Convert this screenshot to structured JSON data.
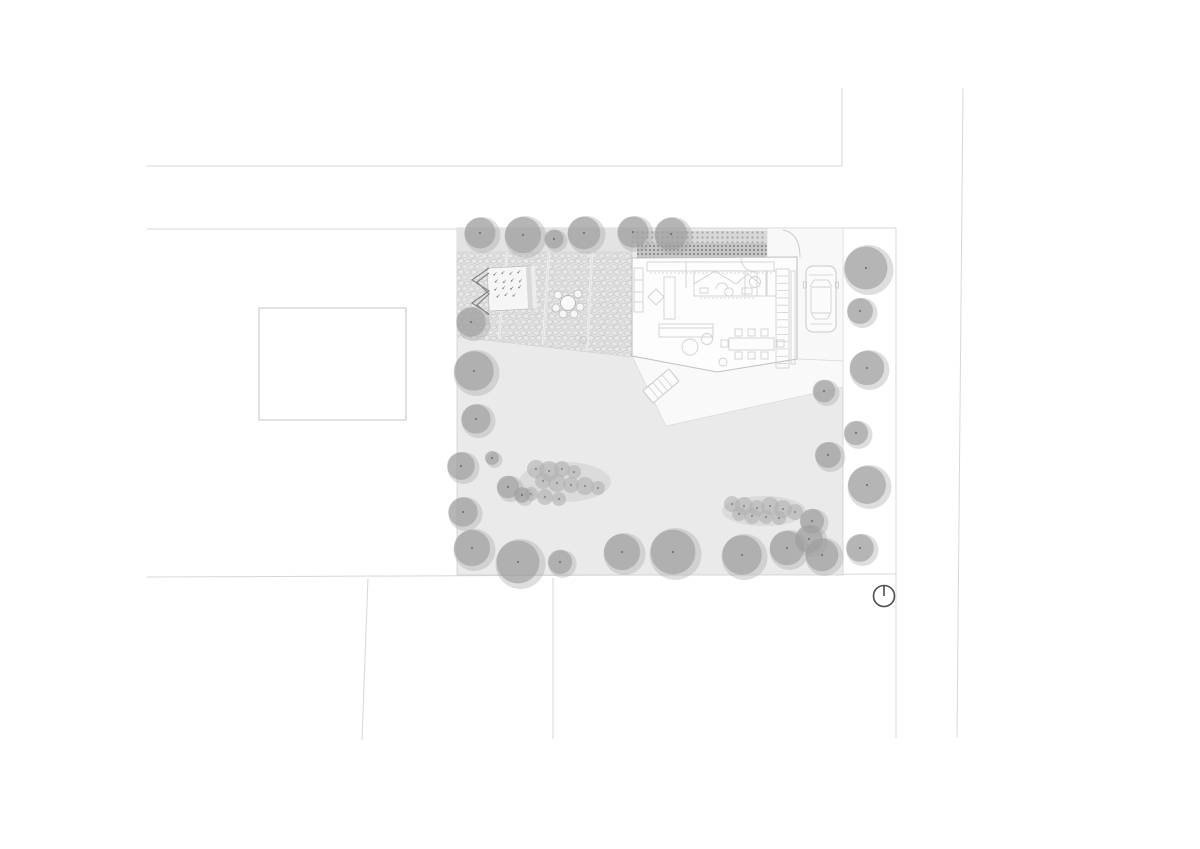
{
  "meta": {
    "title": "architectural-site-plan",
    "width": 1200,
    "height": 849
  },
  "colors": {
    "background": "#ffffff",
    "street_line": "#d7d7d7",
    "garden_fill": "#eaeaea",
    "garden_edge": "#cfcfcf",
    "band_fill": "#e3e3e3",
    "paving_bg": "#e1e1e1",
    "stone_line": "#c6c6c6",
    "stone_fill": "#e8e8e8",
    "joint_light": "#efefef",
    "joint_dark": "#d6d6d6",
    "hatch_light": "#d8d8d8",
    "hatch_dark": "#c7c7c7",
    "dot_light": "#a5a5a5",
    "dot_dark": "#8a8a8a",
    "white_area": "#f8f8f8",
    "white_edge": "#dadada",
    "house_fill": "#fdfdfd",
    "house_outline": "#c2c2c2",
    "furniture": "#d1d1d1",
    "tree_outer": "#a9a9a9",
    "tree_inner": "#9d9d9d",
    "tree_dot": "#6f6f6f",
    "bush_fill": "#b0b0b0",
    "bush_halo": "#c6c6c6",
    "bush_dot": "#838383",
    "bed_line": "#868686",
    "plant_dot": "#8f8f8f",
    "north": "#4d4d4d"
  },
  "streets": {
    "lines": [
      {
        "x1": 147,
        "y1": 166,
        "x2": 842,
        "y2": 166
      },
      {
        "x1": 842,
        "y1": 166,
        "x2": 842,
        "y2": 88
      },
      {
        "x1": 147,
        "y1": 229,
        "x2": 457,
        "y2": 229
      },
      {
        "x1": 963,
        "y1": 88,
        "x2": 957,
        "y2": 737
      },
      {
        "x1": 147,
        "y1": 577,
        "x2": 896,
        "y2": 574
      },
      {
        "x1": 368,
        "y1": 578,
        "x2": 362,
        "y2": 740
      },
      {
        "x1": 553,
        "y1": 578,
        "x2": 553,
        "y2": 739
      },
      {
        "x1": 896,
        "y1": 228,
        "x2": 896,
        "y2": 738
      },
      {
        "x1": 843,
        "y1": 228,
        "x2": 896,
        "y2": 228
      }
    ]
  },
  "neighbor_building": {
    "x": 259,
    "y": 308,
    "w": 147,
    "h": 112
  },
  "site": {
    "garden": {
      "x": 457,
      "y": 228,
      "w": 386,
      "h": 347
    },
    "band": {
      "x": 457,
      "y": 228,
      "w": 175,
      "h": 24
    },
    "paving_points": "457,252 632,252 632,357 457,337",
    "paving_joints": [
      {
        "x1": 507,
        "y1": 252,
        "x2": 499,
        "y2": 338
      },
      {
        "x1": 549,
        "y1": 252,
        "x2": 543,
        "y2": 344
      },
      {
        "x1": 592,
        "y1": 252,
        "x2": 587,
        "y2": 351
      }
    ],
    "wall_line": {
      "x1": 632,
      "y1": 228,
      "x2": 632,
      "y2": 258
    },
    "hatch_strips": [
      {
        "x": 632,
        "y": 231,
        "w": 135,
        "h": 12,
        "tone": "light"
      },
      {
        "x": 637,
        "y": 243,
        "w": 130,
        "h": 15,
        "tone": "dark"
      }
    ],
    "entry_points": "767,228 843,228 843,361 797,359 797,258 767,258",
    "deck_points": "632,356 717,371 797,359 843,361 843,387 666,426"
  },
  "planted_bed": {
    "rotation": -3,
    "cx": 510,
    "cy": 288,
    "rect": {
      "x": 488,
      "y": 267,
      "w": 45,
      "h": 43
    },
    "strips": [
      {
        "x": 527,
        "y": 267,
        "w": 5,
        "h": 43
      },
      {
        "x": 532,
        "y": 267,
        "w": 4,
        "h": 43
      }
    ],
    "plants": [
      [
        495,
        274
      ],
      [
        503,
        273
      ],
      [
        511,
        274
      ],
      [
        519,
        273
      ],
      [
        496,
        281
      ],
      [
        504,
        282
      ],
      [
        512,
        281
      ],
      [
        520,
        282
      ],
      [
        495,
        289
      ],
      [
        503,
        288
      ],
      [
        511,
        289
      ],
      [
        519,
        288
      ],
      [
        497,
        296
      ],
      [
        505,
        295
      ],
      [
        513,
        296
      ]
    ]
  },
  "zigzag_paths": [
    "M489,268 L472,280 L489,291 L472,303 L489,314",
    "M489,273 L477,282 L489,294 L477,305 L489,315"
  ],
  "garden_table": {
    "cx": 568,
    "cy": 303,
    "r": 7.5,
    "chair_r": 4,
    "chairs": [
      [
        558,
        295
      ],
      [
        578,
        294
      ],
      [
        556,
        308
      ],
      [
        580,
        307
      ],
      [
        563,
        314
      ],
      [
        574,
        314
      ]
    ]
  },
  "drain": {
    "cx": 583,
    "cy": 340,
    "r": 3.5
  },
  "house": {
    "outline_points": "632,258 797,257 797,359 717,372 632,356",
    "rects": [
      {
        "x": 647,
        "y": 262,
        "w": 127,
        "h": 9
      },
      {
        "x": 634,
        "y": 268,
        "w": 9,
        "h": 44
      },
      {
        "x": 664,
        "y": 277,
        "w": 11,
        "h": 42
      },
      {
        "x": 694,
        "y": 271,
        "w": 63,
        "h": 25
      },
      {
        "x": 745,
        "y": 271,
        "w": 21,
        "h": 25
      },
      {
        "x": 767,
        "y": 271,
        "w": 9,
        "h": 25
      },
      {
        "x": 700,
        "y": 288,
        "w": 8,
        "h": 5
      },
      {
        "x": 742,
        "y": 288,
        "w": 10,
        "h": 6
      },
      {
        "x": 659,
        "y": 324,
        "w": 54,
        "h": 13
      },
      {
        "x": 729,
        "y": 338,
        "w": 45,
        "h": 12
      },
      {
        "x": 776,
        "y": 269,
        "w": 13,
        "h": 99
      },
      {
        "x": 791,
        "y": 271,
        "w": 4,
        "h": 93
      }
    ],
    "chair_size": 7,
    "chairs": [
      [
        735,
        329
      ],
      [
        748,
        329
      ],
      [
        761,
        329
      ],
      [
        735,
        352
      ],
      [
        748,
        352
      ],
      [
        761,
        352
      ],
      [
        721,
        340
      ],
      [
        777,
        340
      ]
    ],
    "circles": [
      {
        "cx": 690,
        "cy": 347,
        "r": 8
      },
      {
        "cx": 707,
        "cy": 339,
        "r": 5.5
      },
      {
        "cx": 729,
        "cy": 292,
        "r": 4.2
      },
      {
        "cx": 755,
        "cy": 282,
        "r": 5.5
      },
      {
        "cx": 723,
        "cy": 362,
        "r": 4
      }
    ],
    "paths": [
      "M694,284 L715,271 L736,284",
      "M736,284 L748,274 L760,284",
      "M716,289 a6,6 0 0 1 12,0",
      "M741,258 A14,14 0 0 0 755,272",
      "M656,289 L664,297 L656,305 L648,297 Z"
    ],
    "lines": [
      {
        "x1": 659,
        "y1": 328,
        "x2": 713,
        "y2": 328
      },
      {
        "x1": 686,
        "y1": 262,
        "x2": 686,
        "y2": 288
      },
      {
        "x1": 634,
        "y1": 280,
        "x2": 643,
        "y2": 280
      },
      {
        "x1": 634,
        "y1": 292,
        "x2": 643,
        "y2": 292
      },
      {
        "x1": 634,
        "y1": 302,
        "x2": 643,
        "y2": 302
      }
    ],
    "dashed": [
      {
        "x1": 650,
        "y1": 273,
        "x2": 772,
        "y2": 273
      },
      {
        "x1": 700,
        "y1": 298,
        "x2": 756,
        "y2": 298
      }
    ],
    "stairs": {
      "x1": 777,
      "x2": 788,
      "y_start": 276,
      "y_end": 364,
      "step": 7.3
    }
  },
  "gate_arc": "M783,230 Q800,233 800,257",
  "car": {
    "x": 806,
    "y": 266,
    "body": {
      "w": 30,
      "h": 66,
      "rx": 7
    },
    "roof": {
      "x": 5,
      "y": 21,
      "w": 20,
      "h": 26
    },
    "lines": [
      [
        3,
        9,
        27,
        9
      ],
      [
        4,
        21,
        8,
        14
      ],
      [
        26,
        21,
        22,
        14
      ],
      [
        8,
        14,
        22,
        14
      ],
      [
        5,
        47,
        9,
        53
      ],
      [
        25,
        47,
        21,
        53
      ],
      [
        9,
        53,
        21,
        53
      ],
      [
        4,
        58,
        26,
        58
      ]
    ],
    "mirrors": [
      {
        "x": -2.5,
        "y": 16,
        "w": 3,
        "h": 6
      },
      {
        "x": 29.5,
        "y": 16,
        "w": 3,
        "h": 6
      }
    ]
  },
  "lounger": {
    "x": 661,
    "y": 386,
    "rotation": -40,
    "w": 34,
    "h": 16,
    "rungs": [
      -10,
      -4,
      2,
      8
    ]
  },
  "bushes": {
    "clusters": [
      {
        "halo": {
          "cx": 565,
          "cy": 482,
          "rx": 46,
          "ry": 20
        },
        "circles": [
          [
            536,
            469,
            9
          ],
          [
            549,
            471,
            10
          ],
          [
            562,
            469,
            8
          ],
          [
            574,
            472,
            7
          ],
          [
            543,
            481,
            8
          ],
          [
            557,
            483,
            9
          ],
          [
            571,
            485,
            8
          ],
          [
            585,
            486,
            9
          ],
          [
            598,
            488,
            7
          ],
          [
            531,
            494,
            7
          ],
          [
            545,
            497,
            8
          ],
          [
            559,
            499,
            7
          ]
        ]
      },
      {
        "halo": {
          "cx": 764,
          "cy": 511,
          "rx": 42,
          "ry": 15
        },
        "circles": [
          [
            732,
            504,
            8
          ],
          [
            744,
            506,
            9
          ],
          [
            757,
            508,
            8
          ],
          [
            770,
            506,
            9
          ],
          [
            783,
            509,
            9
          ],
          [
            795,
            512,
            8
          ],
          [
            739,
            514,
            7
          ],
          [
            752,
            516,
            8
          ],
          [
            766,
            517,
            7
          ],
          [
            779,
            518,
            7
          ]
        ]
      }
    ]
  },
  "trees": [
    [
      480,
      233,
      18
    ],
    [
      523,
      235,
      21
    ],
    [
      554,
      239,
      11
    ],
    [
      584,
      233,
      19
    ],
    [
      633,
      232,
      18
    ],
    [
      671,
      234,
      19
    ],
    [
      471,
      322,
      17
    ],
    [
      474,
      371,
      23
    ],
    [
      476,
      419,
      17
    ],
    [
      461,
      466,
      16
    ],
    [
      492,
      458,
      8
    ],
    [
      463,
      512,
      17
    ],
    [
      508,
      487,
      13
    ],
    [
      522,
      495,
      9
    ],
    [
      472,
      548,
      21
    ],
    [
      518,
      562,
      25
    ],
    [
      560,
      562,
      14
    ],
    [
      622,
      552,
      21
    ],
    [
      673,
      552,
      26
    ],
    [
      742,
      555,
      23
    ],
    [
      787,
      548,
      20
    ],
    [
      809,
      539,
      16
    ],
    [
      822,
      555,
      19
    ],
    [
      860,
      548,
      16
    ],
    [
      824,
      391,
      13
    ],
    [
      828,
      455,
      15
    ],
    [
      812,
      521,
      14
    ],
    [
      866,
      268,
      25
    ],
    [
      860,
      311,
      15
    ],
    [
      867,
      368,
      20
    ],
    [
      856,
      433,
      14
    ],
    [
      867,
      485,
      22
    ]
  ],
  "north_arrow": {
    "cx": 884,
    "cy": 596,
    "r": 10.5
  }
}
